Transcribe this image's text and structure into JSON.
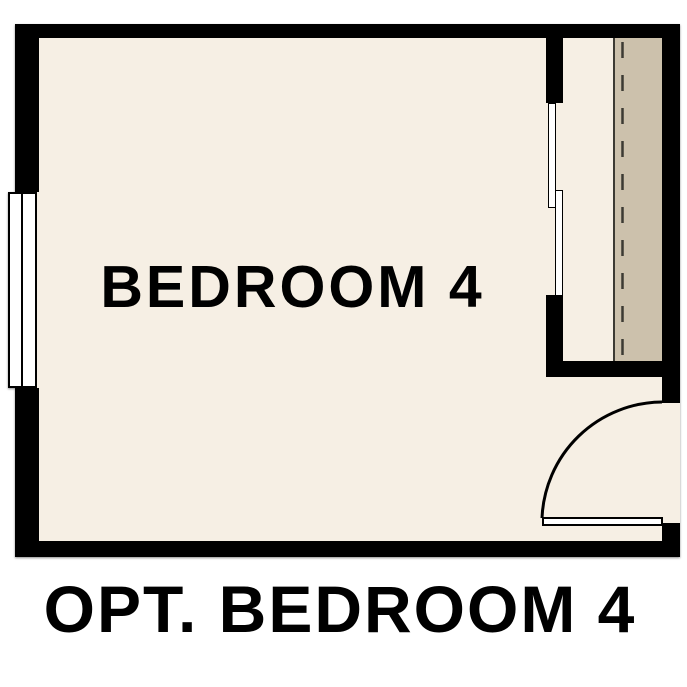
{
  "page": {
    "background": "#ffffff"
  },
  "colors": {
    "wall": "#000000",
    "floor": "#f6efe4",
    "shelf": "#ccc1ac",
    "line": "#3c3a33",
    "fixture": "#ffffff",
    "text": "#000000"
  },
  "plan": {
    "room_label": "BEDROOM 4",
    "caption": "OPT. BEDROOM 4",
    "symbols": {
      "window": "double-window",
      "closet_doors": "bypass-sliding-doors",
      "entry_door": "hinged-door-open-90",
      "closet_rod": "dashed-rod-line"
    }
  }
}
